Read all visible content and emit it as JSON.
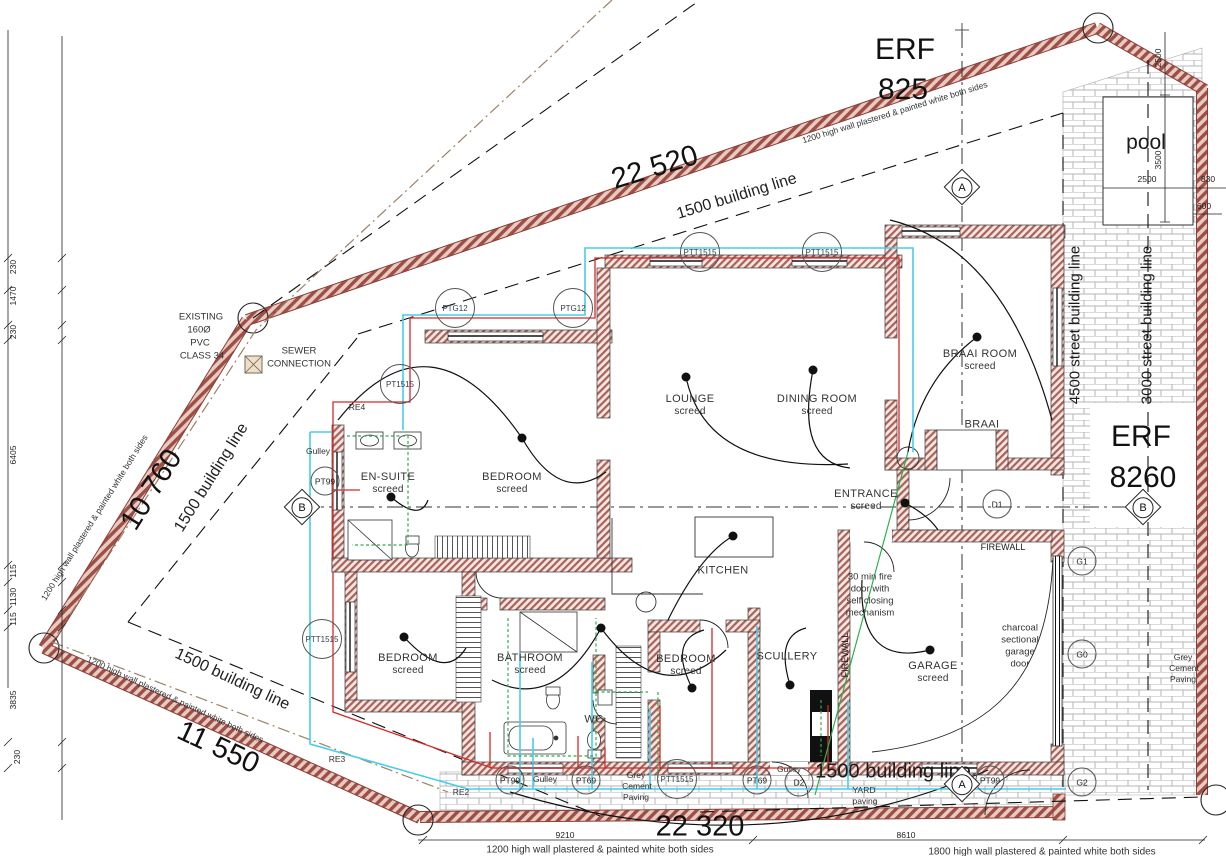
{
  "plan": {
    "erf_top": {
      "l1": "ERF",
      "l2": "825"
    },
    "erf_right": {
      "l1": "ERF",
      "l2": "8260"
    },
    "pool": {
      "label": "pool",
      "top": "2500",
      "height": "3500",
      "width": "2500",
      "right": "830",
      "corner": "600"
    },
    "dims": {
      "top": "22 520",
      "nw": "10 760",
      "sw": "11 550",
      "bottom": "22 320",
      "bottom_left": "9210",
      "bottom_right": "8610"
    },
    "chain": {
      "c1": "230",
      "c2": "1470",
      "c3": "230",
      "c4": "6405",
      "c5": "115",
      "c6": "1130",
      "c7": "115",
      "c8": "3835",
      "c9": "230"
    },
    "lines": {
      "building": "1500 building line",
      "s4500": "4500 street building line",
      "s3000": "3000 street building line"
    },
    "notes": {
      "w1200": "1200 high wall plastered & painted white both sides",
      "w1800": "1800 high wall plastered & painted white both sides",
      "ex1": "EXISTING",
      "ex2": "160Ø",
      "ex3": "PVC",
      "ex4": "CLASS 34",
      "sw1": "SEWER",
      "sw2": "CONNECTION",
      "fd1": "30 min fire",
      "fd2": "door with",
      "fd3": "self closing",
      "fd4": "mechanism",
      "gd1": "charcoal",
      "gd2": "sectional",
      "gd3": "garage",
      "gd4": "door",
      "gp1": "Grey",
      "gp2": "Cement",
      "gp3": "Paving",
      "yp1": "YARD",
      "yp2": "paving",
      "gulley": "Gulley"
    },
    "rooms": {
      "ensuite": "EN-SUITE",
      "bedroom": "BEDROOM",
      "lounge": "LOUNGE",
      "dining": "DINING ROOM",
      "braairoom": "BRAAI ROOM",
      "braai": "BRAAI",
      "entrance": "ENTRANCE",
      "kitchen": "KITCHEN",
      "scullery": "SCULLERY",
      "bathroom": "BATHROOM",
      "wc": "WC",
      "garage": "GARAGE",
      "firewall": "FIREWALL",
      "screed": "screed"
    },
    "tags": {
      "ptt1515": "PTT1515",
      "ptg12": "PTG12",
      "pt1515": "PT1515",
      "pt99": "PT99",
      "pt69": "PT69",
      "re4": "RE4",
      "re3": "RE3",
      "re2": "RE2",
      "d1": "D1",
      "d2": "D2",
      "g1": "G1",
      "g0": "G0",
      "g2": "G2",
      "a": "A",
      "b": "B"
    },
    "colors": {
      "wall_hatch": "#9c4f44",
      "pipe_hot": "#d42a28",
      "pipe_cold": "#46cde8",
      "pipe_waste": "#2fae4e",
      "brick": "#b5b5b5"
    }
  }
}
